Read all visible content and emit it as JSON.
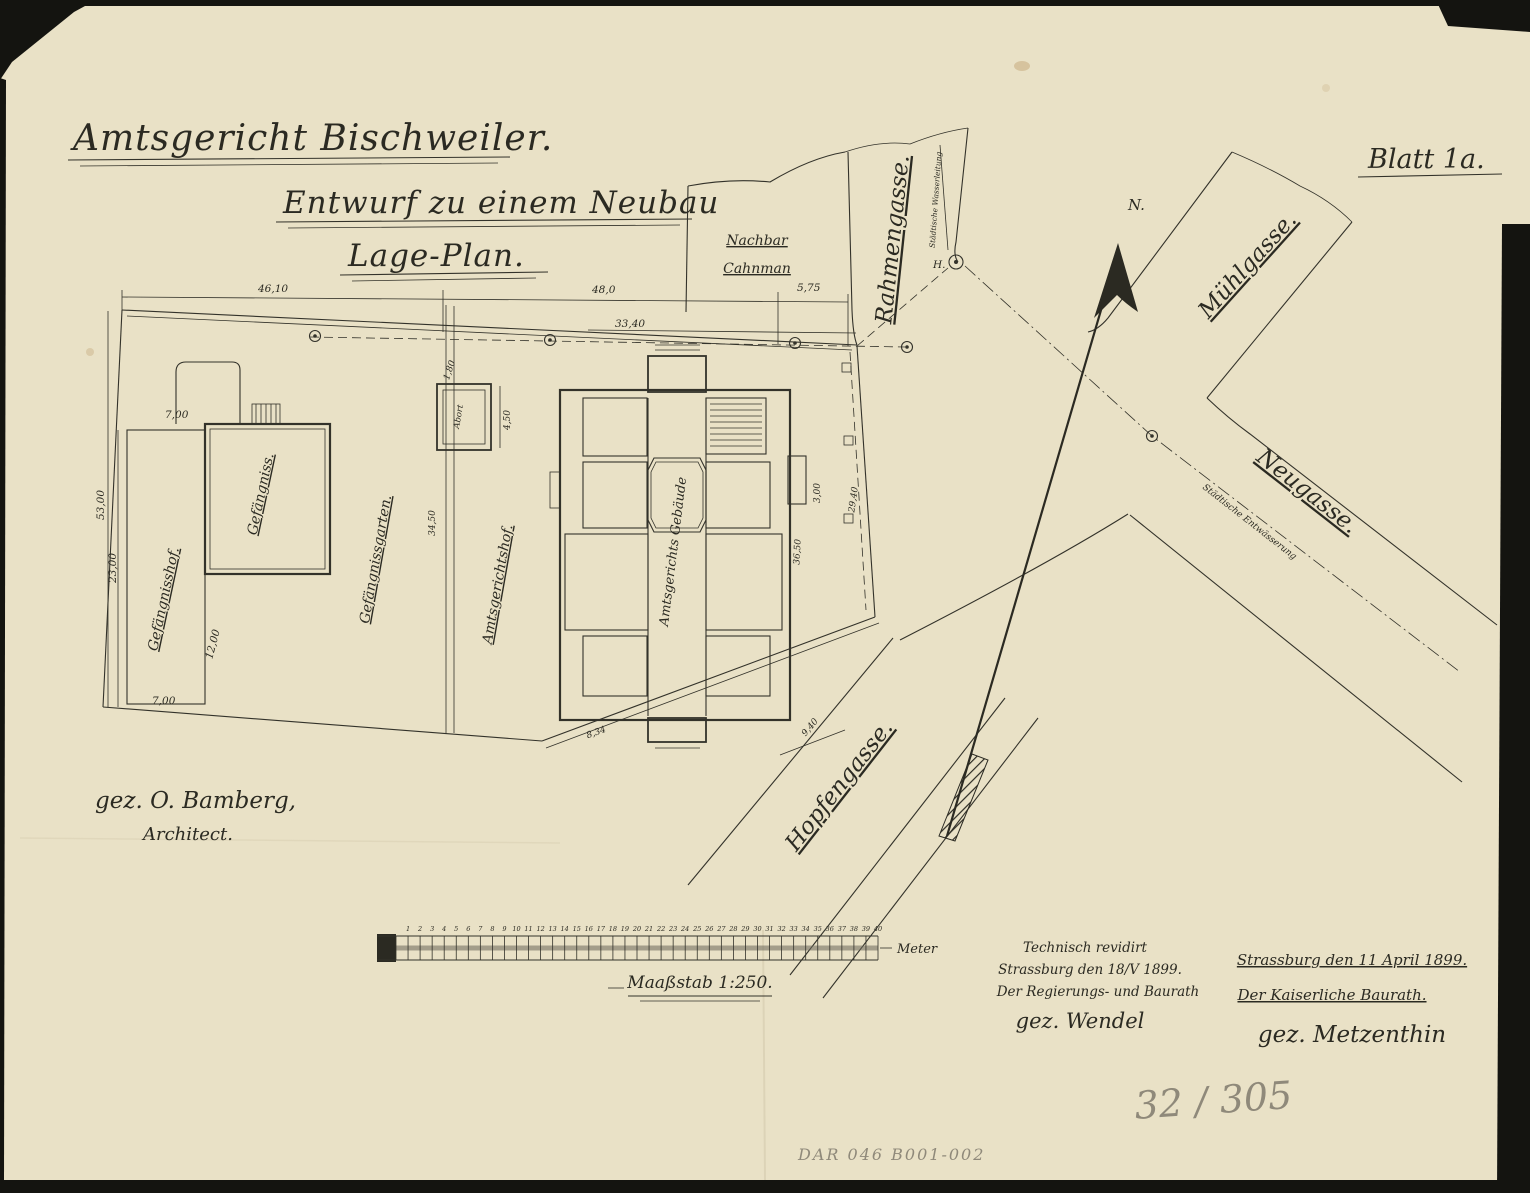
{
  "document": {
    "title": {
      "line1": "Amtsgericht Bischweiler.",
      "line2": "Entwurf zu einem Neubau",
      "line3": "Lage-Plan."
    },
    "sheet_label": "Blatt 1a.",
    "architect_signature": {
      "line1": "gez. O. Bamberg,",
      "line2": "Architect."
    },
    "revision_note": {
      "line1": "Technisch revidirt",
      "line2": "Strassburg den 18/V 1899.",
      "line3": "Der Regierungs- und Baurath",
      "line4": "gez. Wendel"
    },
    "approval_note": {
      "line1": "Strassburg den 11 April 1899.",
      "line2": "Der Kaiserliche Baurath.",
      "line3": "gez. Metzenthin"
    },
    "archive_number_pencil": "32 / 305",
    "archive_code_pencil": "DAR 046  B001-002"
  },
  "plan": {
    "north_label": "N.",
    "neighbor": {
      "line1": "Nachbar",
      "line2": "Cahnman"
    },
    "streets": {
      "rahmengasse": "Rahmengasse.",
      "muehlgasse": "Mühlgasse.",
      "neugasse": "Neugasse.",
      "hopfengasse": "Hopfengasse."
    },
    "utilities": {
      "water_line": "Städtische Wasserleitung",
      "sewer_line": "Städtische Entwässerung",
      "hydrant": "H."
    },
    "areas": {
      "gefaengnisshof": "Gefängnisshof.",
      "gefaengniss": "Gefängniss.",
      "gefaengnissgarten": "Gefängnissgarten.",
      "amtsgerichtshof": "Amtsgerichtshof.",
      "hauptgebaeude": "Amtsgerichts Gebäude",
      "abort": "Abort"
    },
    "dimensions": {
      "top_left": "46,10",
      "top_mid": "48,0",
      "top_right": "5,75",
      "top_inner": "33,40",
      "left_outer": "53,00",
      "left_inner": "23,00",
      "hof_top": "7,00",
      "hof_mid": "12,00",
      "hof_bottom": "7,00",
      "garten_width": "34,50",
      "abort_w": "1,80",
      "abort_h": "4,50",
      "gap_right": "3,00",
      "right_upper": "29,40",
      "right_lower": "36,50",
      "hopfen_width": "9,40",
      "bottom_small": "8,34"
    }
  },
  "scale_bar": {
    "caption": "Maaßstab 1:250.",
    "unit": "Meter",
    "ticks": [
      1,
      2,
      3,
      4,
      5,
      6,
      7,
      8,
      9,
      10,
      11,
      12,
      13,
      14,
      15,
      16,
      17,
      18,
      19,
      20,
      21,
      22,
      23,
      24,
      25,
      26,
      27,
      28,
      29,
      30,
      31,
      32,
      33,
      34,
      35,
      36,
      37,
      38,
      39,
      40
    ]
  }
}
